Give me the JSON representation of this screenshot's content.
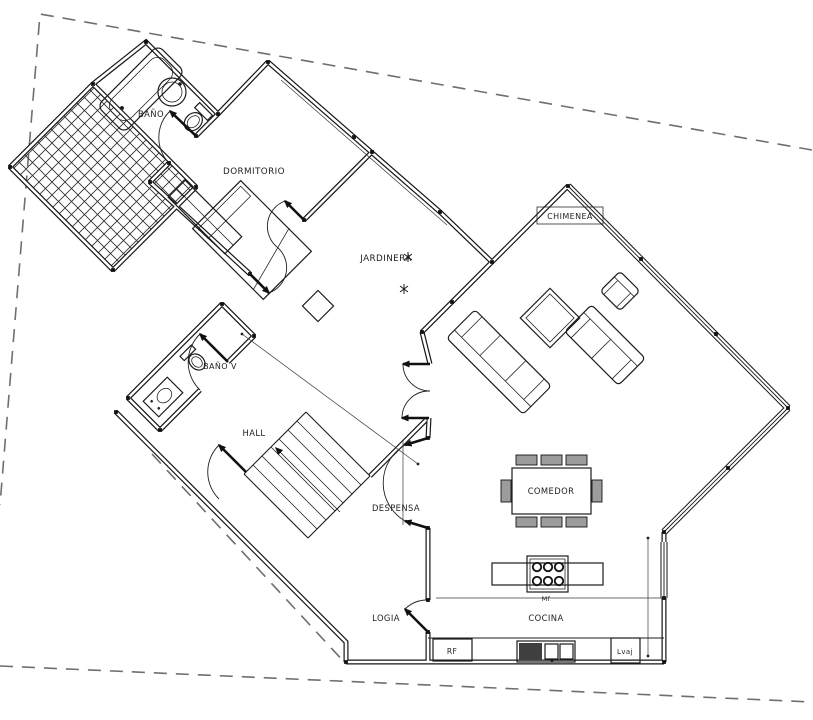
{
  "meta": {
    "drawing_type": "architectural floor plan",
    "language": "Spanish"
  },
  "colors": {
    "background": "#ffffff",
    "walls": "#161616",
    "boundary_dashed": "#6f6f6f",
    "dark_fill": "#3f3f3f",
    "chair_fill": "#9c9c9c"
  },
  "rooms": [
    {
      "id": "bano",
      "label": "BAÑO"
    },
    {
      "id": "dormitorio",
      "label": "DORMITORIO"
    },
    {
      "id": "jardinera",
      "label": "JARDINERA"
    },
    {
      "id": "chimenea",
      "label": "CHIMENEA"
    },
    {
      "id": "bano_visitas",
      "label": "BAÑO V"
    },
    {
      "id": "hall",
      "label": "HALL"
    },
    {
      "id": "despensa",
      "label": "DESPENSA"
    },
    {
      "id": "comedor",
      "label": "COMEDOR"
    },
    {
      "id": "cocina",
      "label": "COCINA"
    },
    {
      "id": "logia",
      "label": "LOGIA"
    }
  ],
  "appliances": [
    {
      "id": "refrigerator",
      "label": "RF"
    },
    {
      "id": "dishwasher",
      "label": "Lvaj"
    },
    {
      "id": "island_mark",
      "label": "Mf"
    }
  ],
  "features": [
    "property-boundary-dashed",
    "trellis-deck-hatched",
    "bathtub",
    "round-washbasin",
    "toilet",
    "bed-with-pillow",
    "wardrobe",
    "stair-with-arrow",
    "door-swings",
    "sofa-3-seat",
    "sofa-2-seat",
    "armchair",
    "coffee-table",
    "fireplace",
    "dining-table-8-chairs",
    "kitchen-island-cooktop-6-burners",
    "kitchen-sink",
    "window-glazing-bands"
  ]
}
